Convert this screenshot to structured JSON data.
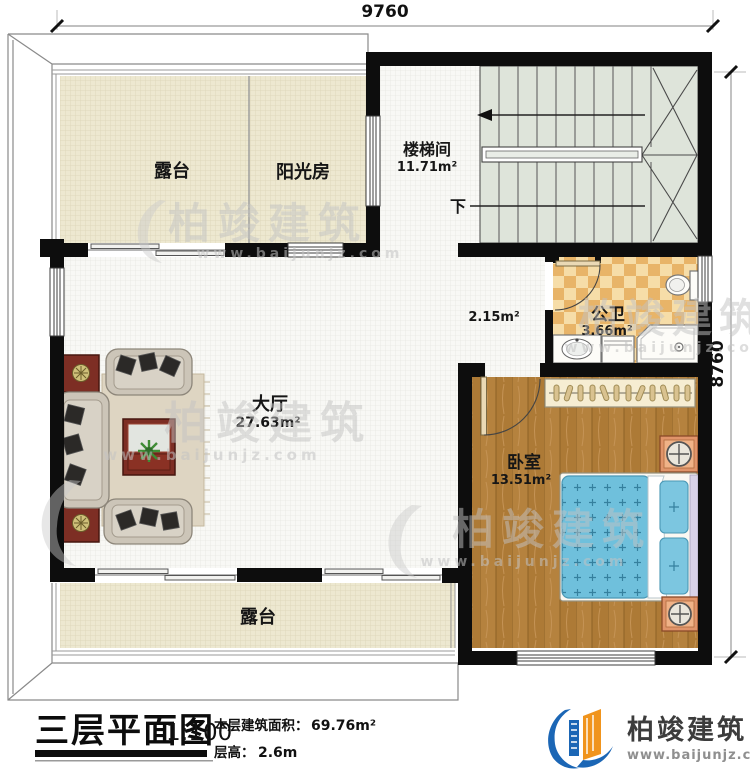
{
  "dimensions": {
    "top": "9760",
    "right": "8760"
  },
  "rooms": {
    "terrace_top": {
      "label": "露台"
    },
    "sunroom": {
      "label": "阳光房"
    },
    "stairwell": {
      "label": "楼梯间",
      "area": "11.71m²"
    },
    "corridor": {
      "area": "2.15m²"
    },
    "bathroom": {
      "label": "公卫",
      "area": "3.66m²"
    },
    "hall": {
      "label": "大厅",
      "area": "27.63m²"
    },
    "bedroom": {
      "label": "卧室",
      "area": "13.51m²"
    },
    "terrace_bottom": {
      "label": "露台"
    }
  },
  "stair": {
    "down_label": "下"
  },
  "title_block": {
    "title": "三层平面图",
    "scale": "1:100",
    "area_label": "本层建筑面积：",
    "area_value": "69.76m²",
    "height_label": "层高：",
    "height_value": "2.6m"
  },
  "logo": {
    "name": "柏竣建筑",
    "url": "www.baijunjz.com"
  },
  "watermark": {
    "text": "柏竣建筑",
    "url": "www.baijunjz.com"
  },
  "colors": {
    "wall": "#0d0d0d",
    "tile_cream": "#ede8d0",
    "tile_white": "#f8f8f5",
    "bath_tile_orange": "#e8b468",
    "bath_tile_cream": "#f6dda8",
    "wood": "#b5823e",
    "stairs": "#dee4da",
    "bed_teal": "#6fc0dc",
    "nightstand_orange": "#e0946a",
    "table_red": "#7d2e24",
    "logo_blue": "#1b66b5",
    "logo_orange": "#f0941d"
  }
}
